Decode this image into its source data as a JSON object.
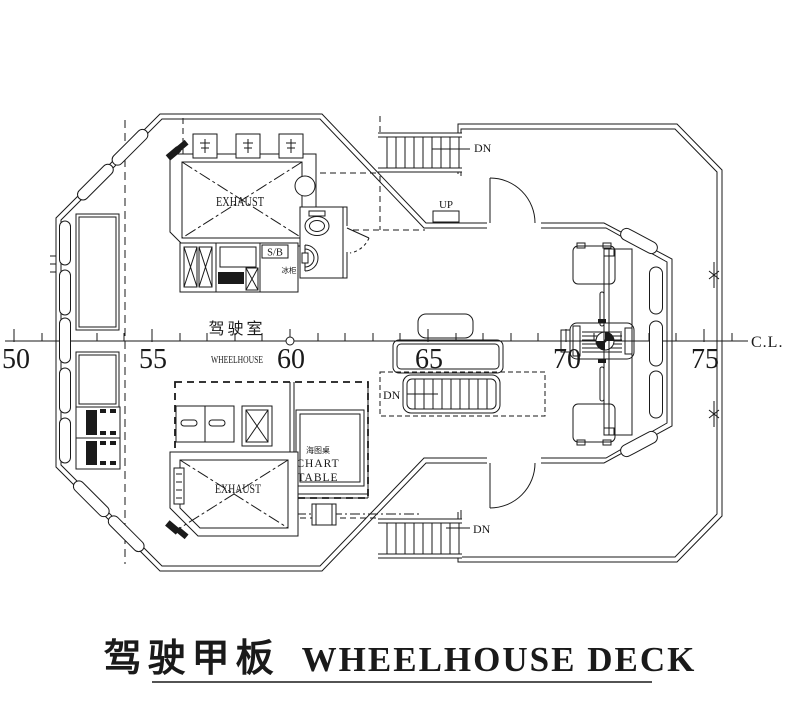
{
  "colors": {
    "line": "#1a1a1a",
    "bg": "#ffffff"
  },
  "title": {
    "cn": "驾驶甲板",
    "en": "WHEELHOUSE DECK"
  },
  "centerline": {
    "label": "C.L."
  },
  "frames": {
    "f50": "50",
    "f55": "55",
    "f60": "60",
    "f65": "65",
    "f70": "70",
    "f75": "75"
  },
  "wheelhouse": {
    "name_cn": "驾驶室",
    "name_en": "WHEELHOUSE"
  },
  "exhaust": {
    "top": "EXHAUST",
    "bottom": "EXHAUST"
  },
  "chart_table": {
    "cn": "海图桌",
    "en_line1": "CHART",
    "en_line2": "TABLE"
  },
  "pantry": {
    "label": "S/B",
    "equip": "冰柜"
  },
  "stairs": {
    "up": "UP",
    "dn_top": "DN",
    "dn_mid": "DN",
    "dn_bottom": "DN"
  }
}
